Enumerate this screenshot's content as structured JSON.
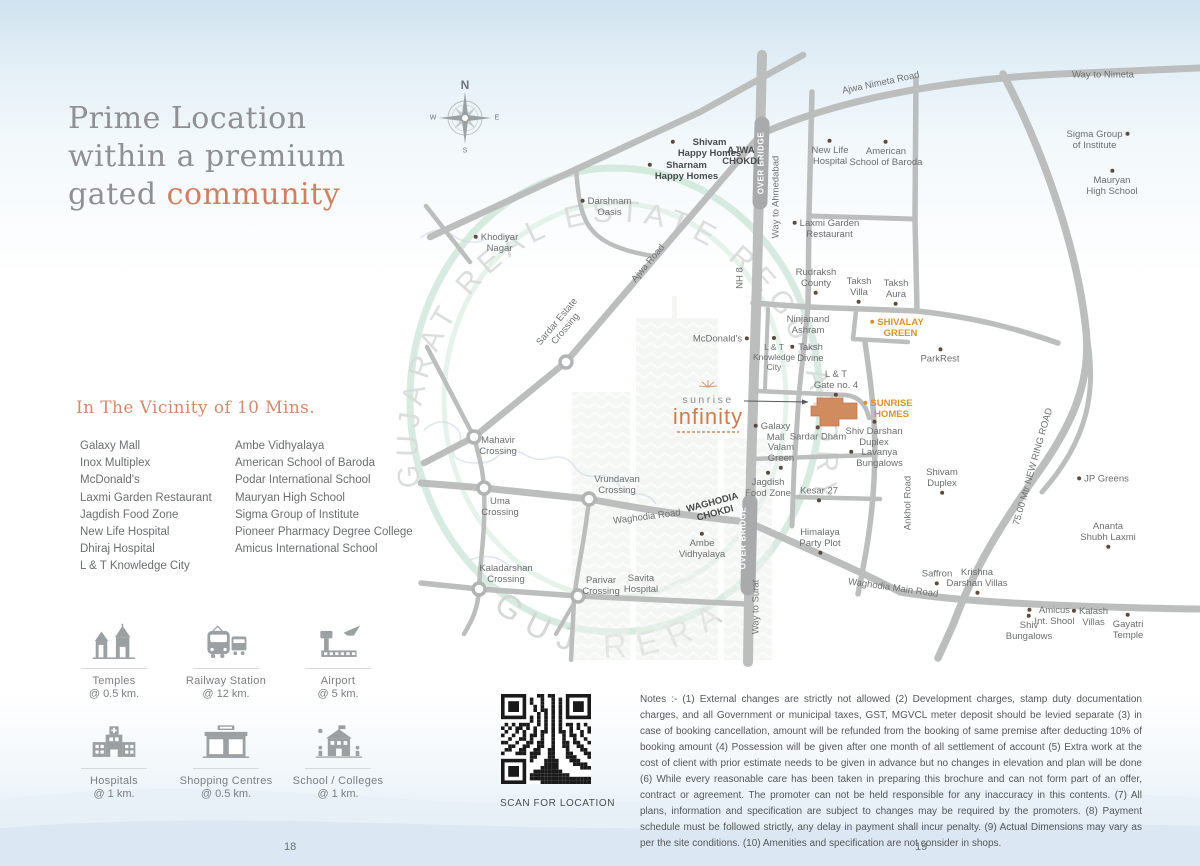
{
  "page": {
    "left_page_number": "18",
    "right_page_number": "19"
  },
  "title": {
    "line1": "Prime Location",
    "line2": "within a premium",
    "line3a": "gated ",
    "line3b": "community"
  },
  "vicinity": {
    "heading": "In The Vicinity of 10 Mins.",
    "column1": [
      "Galaxy Mall",
      "Inox Multiplex",
      "McDonald's",
      "Laxmi Garden Restaurant",
      "Jagdish Food Zone",
      "New Life Hospital",
      "Dhiraj Hospital",
      "L & T Knowledge City"
    ],
    "column2": [
      "Ambe Vidhyalaya",
      "American School of Baroda",
      "Podar International School",
      "Mauryan High School",
      "Sigma Group of Institute",
      "Pioneer Pharmacy Degree College",
      "Amicus International School"
    ]
  },
  "amenities": [
    {
      "icon": "temple-icon",
      "label": "Temples",
      "distance": "@ 0.5 km."
    },
    {
      "icon": "railway-station-icon",
      "label": "Railway Station",
      "distance": "@ 12 km."
    },
    {
      "icon": "airport-icon",
      "label": "Airport",
      "distance": "@ 5 km."
    },
    {
      "icon": "hospital-icon",
      "label": "Hospitals",
      "distance": "@ 1 km."
    },
    {
      "icon": "shopping-centre-icon",
      "label": "Shopping Centres",
      "distance": "@ 0.5 km."
    },
    {
      "icon": "school-icon",
      "label": "School / Colleges",
      "distance": "@ 1 km."
    }
  ],
  "qr": {
    "caption": "SCAN FOR LOCATION"
  },
  "notes": "Notes :- (1) External changes are strictly not allowed (2) Development charges, stamp duty documentation charges, and all Government or municipal taxes, GST, MGVCL meter deposit should be levied separate (3) in case of booking cancellation, amount will be refunded from the booking of same premise after deducting 10% of booking amount (4) Possession will be given after one month of all settlement of account (5) Extra work at the cost of client with prior estimate needs to be given in advance but no changes in elevation and plan will be done (6) While every reasonable care has been taken in preparing this brochure and can not form part of an offer, contract or agreement. The promoter can not be held responsible for any inaccuracy in this contents. (7) All plans, information and specification are subject to changes may be required by the promoters. (8) Payment schedule must be followed strictly, any delay in payment shall incur penalty. (9) Actual Dimensions may vary as per the site conditions. (10) Amenities and specification are not consider in shops.",
  "map": {
    "logo": {
      "name": "sunrise",
      "brand": "infinity"
    },
    "watermark": {
      "ring_text": "GUJARAT REAL ESTATE REGULATORY AUTHORITY",
      "bottom_text": "GUJ RERA"
    },
    "compass": {
      "n": "N",
      "e": "E",
      "s": "S",
      "w": "W"
    },
    "accent_colors": {
      "orange_label": "#d8922e",
      "site_building": "#d08b5f",
      "road": "#bcbdbd"
    },
    "pois": [
      {
        "t": "Shivam\nHappy Homes",
        "x": 706,
        "y": 148,
        "d": "left",
        "b": true
      },
      {
        "t": "Sharnam\nHappy Homes",
        "x": 683,
        "y": 171,
        "d": "left",
        "b": true
      },
      {
        "t": "AJWA\nCHOKDI",
        "x": 741,
        "y": 156,
        "d": "none",
        "b": true
      },
      {
        "t": "Darshnam\nOasis",
        "x": 606,
        "y": 207,
        "d": "left"
      },
      {
        "t": "Khodiyar\nNagar",
        "x": 496,
        "y": 243,
        "d": "left"
      },
      {
        "t": "New Life\nHospital",
        "x": 830,
        "y": 153,
        "d": "above"
      },
      {
        "t": "American\nSchool of Baroda",
        "x": 886,
        "y": 154,
        "d": "above"
      },
      {
        "t": "Sigma Group\nof Institute",
        "x": 1098,
        "y": 140,
        "d": "right"
      },
      {
        "t": "Mauryan\nHigh School",
        "x": 1112,
        "y": 183,
        "d": "above"
      },
      {
        "t": "Laxmi Garden\nRestaurant",
        "x": 826,
        "y": 229,
        "d": "left"
      },
      {
        "t": "Rudraksh\nCounty",
        "x": 816,
        "y": 281,
        "d": "below"
      },
      {
        "t": "Taksh\nVilla",
        "x": 859,
        "y": 290,
        "d": "below"
      },
      {
        "t": "Taksh\nAura",
        "x": 896,
        "y": 292,
        "d": "below"
      },
      {
        "t": "SHIVALAY\nGREEN",
        "x": 897,
        "y": 328,
        "d": "left",
        "c": "orange"
      },
      {
        "t": "Ninjanand\nAshram",
        "x": 808,
        "y": 325,
        "d": "none"
      },
      {
        "t": "McDonald's",
        "x": 721,
        "y": 339,
        "d": "right"
      },
      {
        "t": "L & T\nKnowledge\nCity",
        "x": 774,
        "y": 354,
        "d": "above",
        "s": true
      },
      {
        "t": "Taksh\nDivine",
        "x": 807,
        "y": 353,
        "d": "left"
      },
      {
        "t": "ParkRest",
        "x": 940,
        "y": 356,
        "d": "above"
      },
      {
        "t": "L & T\nGate no. 4",
        "x": 836,
        "y": 383,
        "d": "below"
      },
      {
        "t": "SUNRISE\nHOMES",
        "x": 888,
        "y": 409,
        "d": "left",
        "c": "orange"
      },
      {
        "t": "Galaxy\nMall",
        "x": 772,
        "y": 432,
        "d": "left"
      },
      {
        "t": "Sardar Dham",
        "x": 818,
        "y": 434,
        "d": "above"
      },
      {
        "t": "Shiv Darshan\nDuplex",
        "x": 874,
        "y": 434,
        "d": "above"
      },
      {
        "t": "Valam\nGreen",
        "x": 781,
        "y": 456,
        "d": "below"
      },
      {
        "t": "Lavanya\nBungalows",
        "x": 876,
        "y": 458,
        "d": "left"
      },
      {
        "t": "Jagdish\nFood Zone",
        "x": 768,
        "y": 485,
        "d": "above"
      },
      {
        "t": "Kesar 27",
        "x": 819,
        "y": 494,
        "d": "below"
      },
      {
        "t": "Shivam\nDuplex",
        "x": 942,
        "y": 481,
        "d": "below"
      },
      {
        "t": "Himalaya\nParty Plot",
        "x": 820,
        "y": 541,
        "d": "below"
      },
      {
        "t": "Ambe\nVidhyalaya",
        "x": 702,
        "y": 546,
        "d": "above"
      },
      {
        "t": "Savita\nHospital",
        "x": 641,
        "y": 584,
        "d": "none"
      },
      {
        "t": "Parivar\nCrossing",
        "x": 601,
        "y": 586,
        "d": "none"
      },
      {
        "t": "Kaladarshan\nCrossing",
        "x": 506,
        "y": 574,
        "d": "none"
      },
      {
        "t": "Mahavir\nCrossing",
        "x": 498,
        "y": 446,
        "d": "none"
      },
      {
        "t": "Uma\nCrossing",
        "x": 500,
        "y": 507,
        "d": "none"
      },
      {
        "t": "Vrundavan\nCrossing",
        "x": 617,
        "y": 485,
        "d": "none"
      },
      {
        "t": "JP Greens",
        "x": 1103,
        "y": 479,
        "d": "left"
      },
      {
        "t": "Ananta\nShubh Laxmi",
        "x": 1108,
        "y": 535,
        "d": "below"
      },
      {
        "t": "Saffron",
        "x": 937,
        "y": 577,
        "d": "below"
      },
      {
        "t": "Krishna\nDarshan Villas",
        "x": 977,
        "y": 581,
        "d": "below"
      },
      {
        "t": "Shiv\nBungalows",
        "x": 1029,
        "y": 628,
        "d": "above"
      },
      {
        "t": "Amicus\nInt. Shool",
        "x": 1051,
        "y": 616,
        "d": "left"
      },
      {
        "t": "Kalash\nVillas",
        "x": 1090,
        "y": 617,
        "d": "left"
      },
      {
        "t": "Gayatri\nTemple",
        "x": 1128,
        "y": 627,
        "d": "above"
      }
    ],
    "road_labels": [
      {
        "t": "Ajwa Nimeta Road",
        "x": 881,
        "y": 84,
        "r": -12
      },
      {
        "t": "Way to Nimeta",
        "x": 1103,
        "y": 76,
        "r": 0
      },
      {
        "t": "OVER BRIDGE",
        "x": 761,
        "y": 163,
        "r": -90,
        "s": "white"
      },
      {
        "t": "Way to Ahmedabad",
        "x": 777,
        "y": 197,
        "r": -90
      },
      {
        "t": "NH 8",
        "x": 741,
        "y": 278,
        "r": -90
      },
      {
        "t": "Ajwa Road",
        "x": 649,
        "y": 264,
        "r": -50
      },
      {
        "t": "Sardar Estate\nCrossing",
        "x": 562,
        "y": 326,
        "r": -50
      },
      {
        "t": "WAGHODIA\nCHOKDI",
        "x": 714,
        "y": 509,
        "r": -15,
        "s": "bold"
      },
      {
        "t": "Waghodia Road",
        "x": 647,
        "y": 518,
        "r": -7
      },
      {
        "t": "OVER BRIDGE",
        "x": 743,
        "y": 538,
        "r": -90,
        "s": "white"
      },
      {
        "t": "Way to Surat",
        "x": 757,
        "y": 607,
        "r": -90
      },
      {
        "t": "Ankhol Road",
        "x": 909,
        "y": 503,
        "r": -90
      },
      {
        "t": "Waghodia Main Road",
        "x": 893,
        "y": 589,
        "r": 8
      },
      {
        "t": "75.00 Mtr NEW RING ROAD",
        "x": 1034,
        "y": 467,
        "r": -74
      }
    ]
  }
}
